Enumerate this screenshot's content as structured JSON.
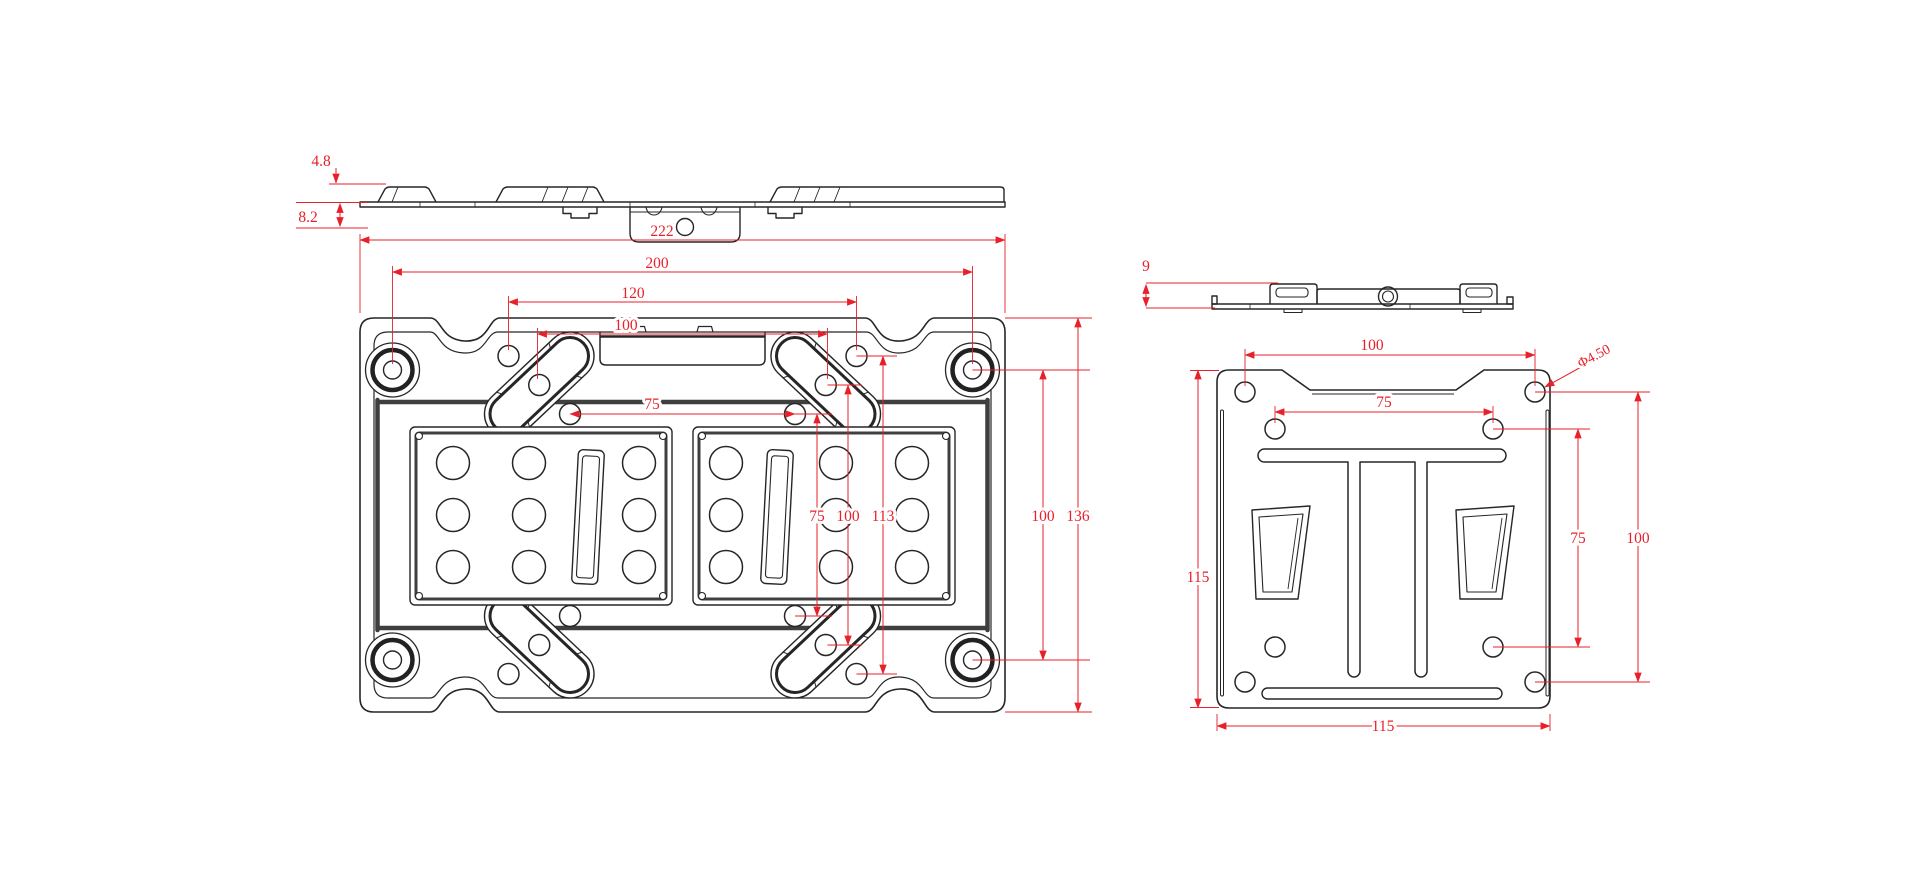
{
  "colors": {
    "background": "#ffffff",
    "line": "#262626",
    "groove": "#3f3f3f",
    "dimension": "#e8202a"
  },
  "views": {
    "wall_plate_side": {
      "dims": {
        "flange_height": "4.8",
        "hook_depth": "8.2"
      }
    },
    "wall_plate_front": {
      "dims": {
        "overall_width": "222",
        "corner_hole_span": "200",
        "slot_outer_span": "120",
        "slot_middle_span": "100",
        "slot_inner_span": "75",
        "inner_vertical_span": "75",
        "middle_vertical_span": "100",
        "outer_vertical_span": "113",
        "corner_hole_vertical_span": "100",
        "overall_height": "136"
      }
    },
    "monitor_plate_side": {
      "dims": {
        "profile_depth": "9"
      }
    },
    "monitor_plate_front": {
      "dims": {
        "corner_hole_span": "100",
        "inner_hole_span": "75",
        "hole_diameter": "Φ4.50",
        "overall_height": "115",
        "inner_hole_vertical_span": "75",
        "corner_hole_vertical_span": "100",
        "overall_width": "115"
      }
    }
  }
}
